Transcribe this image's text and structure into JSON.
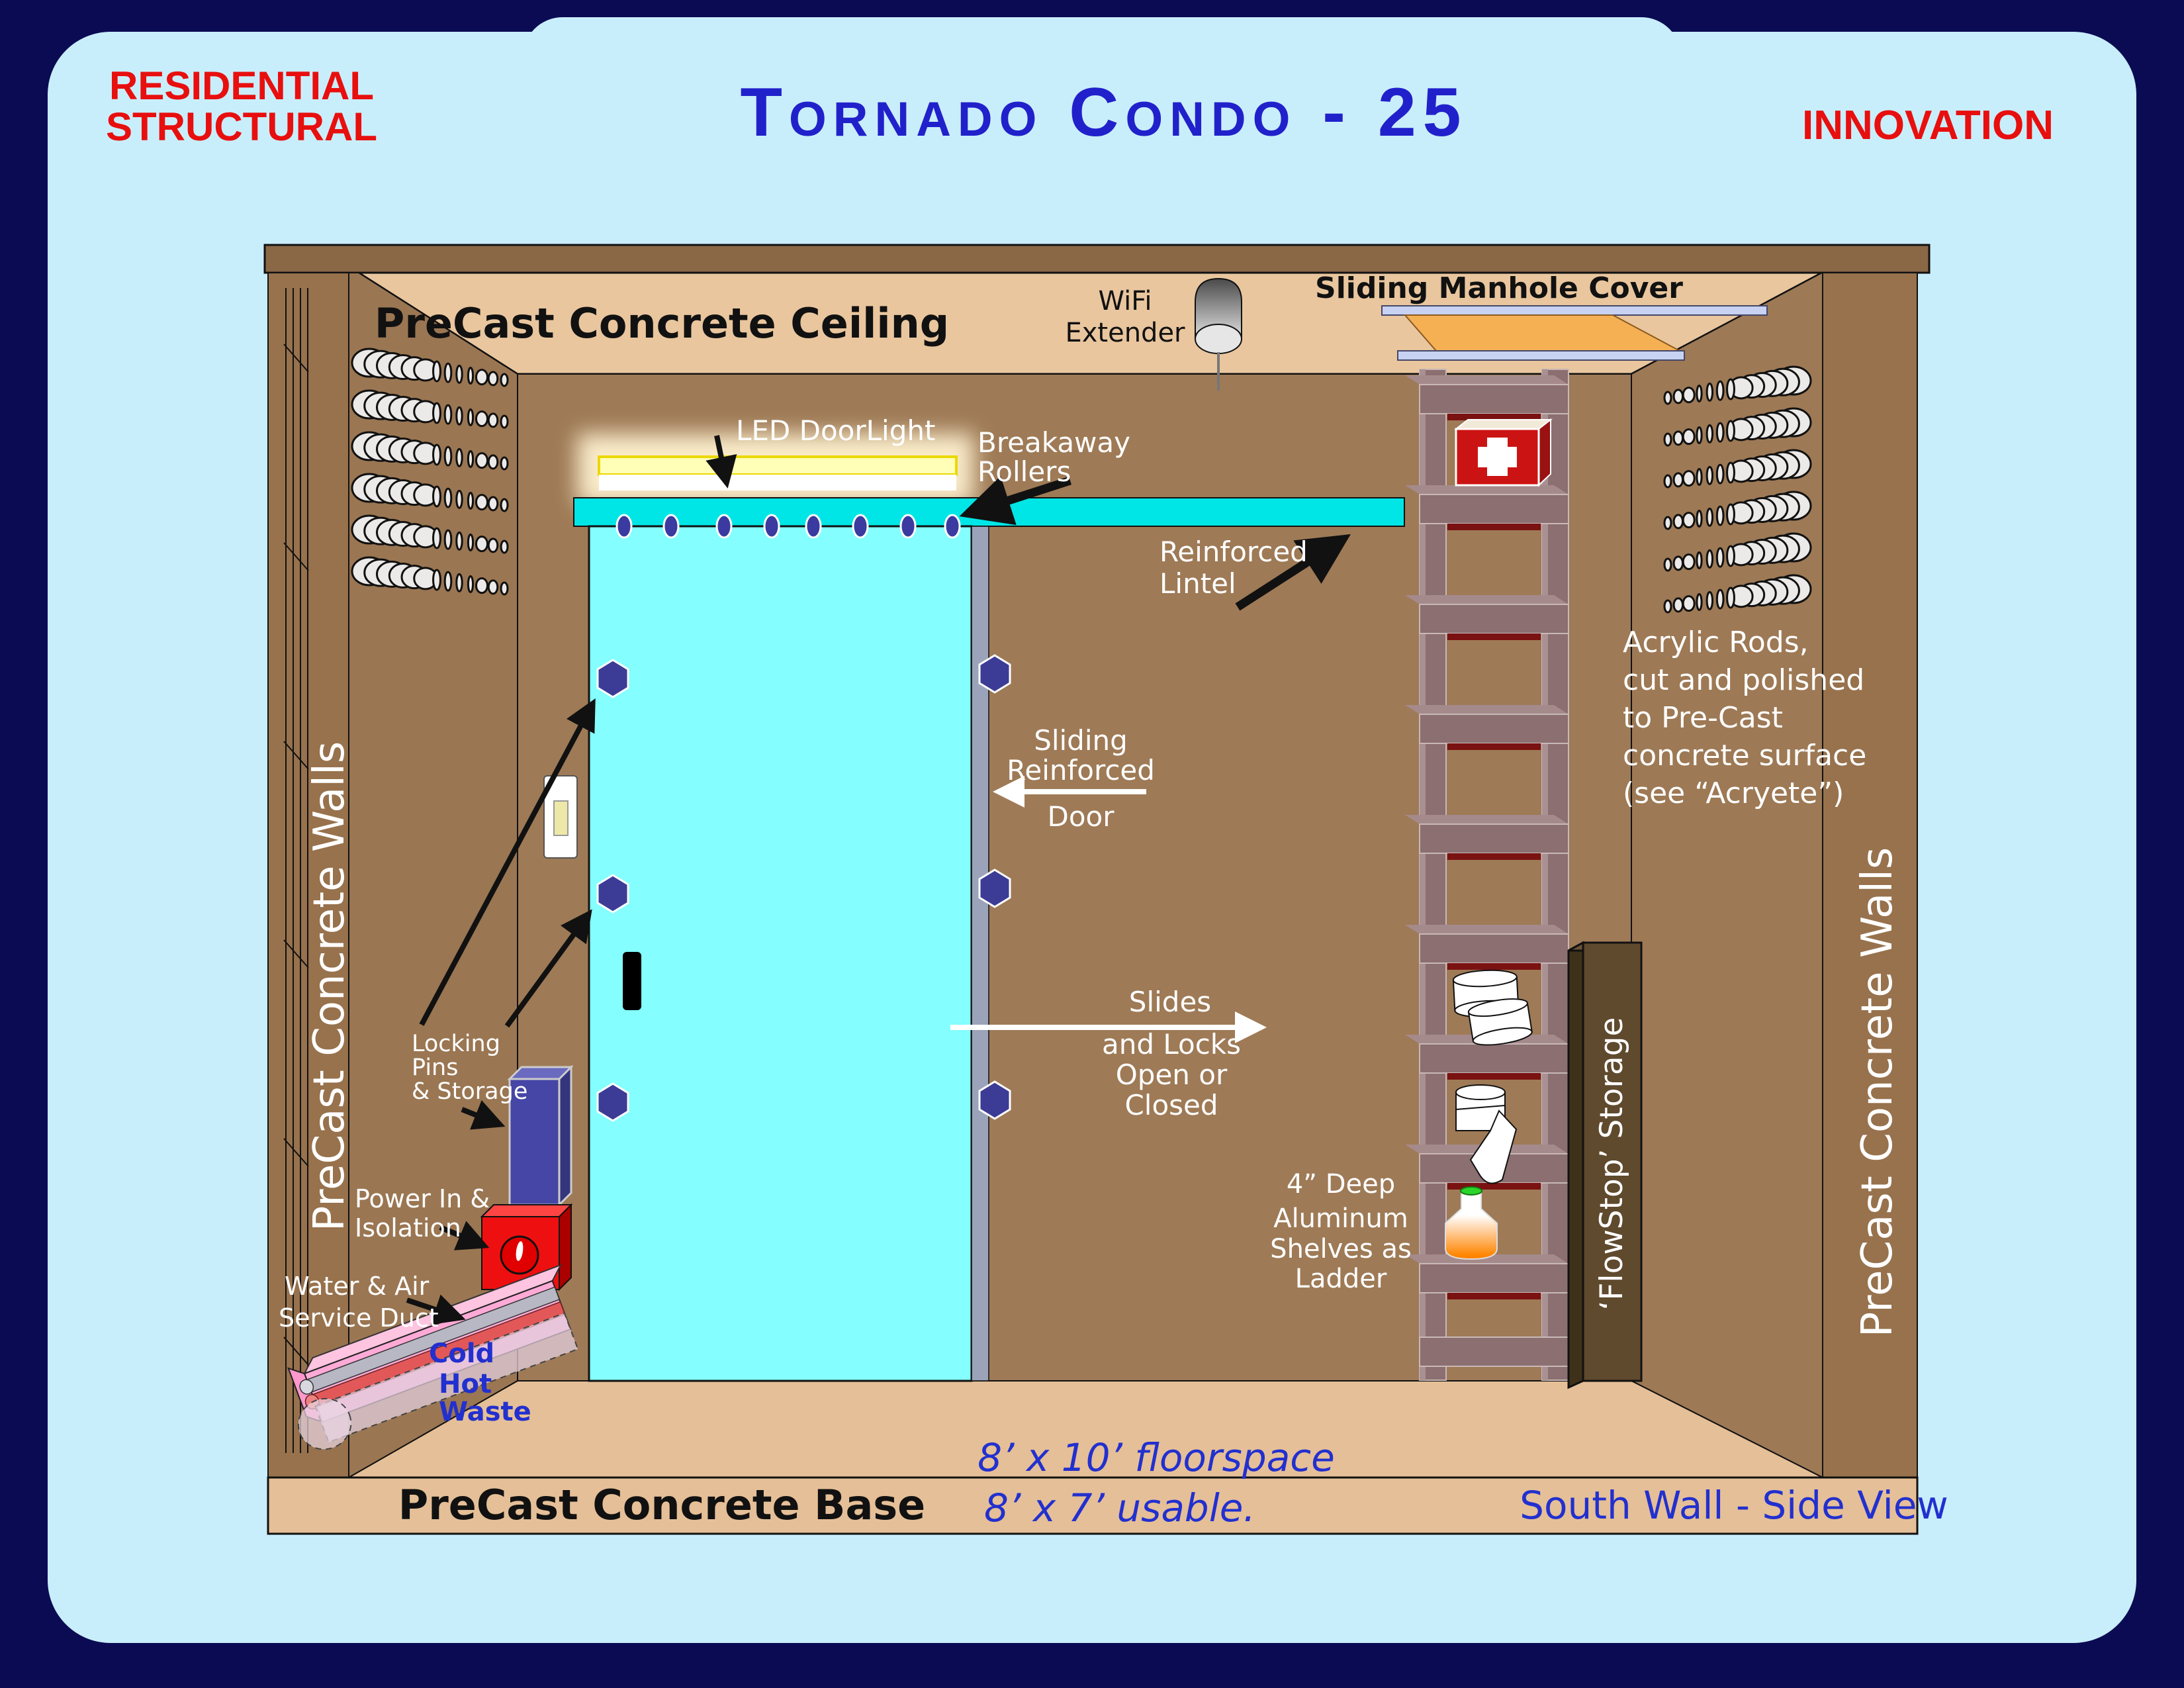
{
  "header": {
    "left_line1": "RESIDENTIAL",
    "left_line2": "STRUCTURAL",
    "title": "Tornado Condo - 25",
    "right": "INNOVATION"
  },
  "colors": {
    "background_navy": "#0b0b54",
    "panel_blue": "#c9eefb",
    "accent_red": "#e80f0f",
    "title_blue": "#2121cb",
    "wall_brown": "#9b7754",
    "ceiling_tan": "#e9c69e",
    "floor_tan": "#e5bf97",
    "door_cyan": "#84fefe",
    "track_cyan": "#00e6e6",
    "pin_navy": "#3c3c96",
    "ladder_mauve": "#8c6f70",
    "duct_pink": "#ffaad6",
    "dim_text_blue": "#2230cf",
    "first_aid_red": "#cc1313",
    "manhole_orange": "#f6b054"
  },
  "diagram": {
    "ceiling_label": "PreCast Concrete Ceiling",
    "base_label": "PreCast Concrete Base",
    "left_wall_label": "PreCast Concrete Walls",
    "right_wall_label": "PreCast Concrete Walls",
    "wifi": [
      "WiFi",
      "Extender"
    ],
    "manhole_label": "Sliding Manhole Cover",
    "led_label": "LED DoorLight",
    "breakaway": [
      "Breakaway",
      "Rollers"
    ],
    "lintel": [
      "Reinforced",
      "Lintel"
    ],
    "sliding_door": [
      "Sliding",
      "Reinforced",
      "Door"
    ],
    "slides": [
      "Slides",
      "and Locks",
      "Open or",
      "Closed"
    ],
    "acrylic": [
      "Acrylic Rods,",
      "cut and polished",
      "to Pre-Cast",
      "concrete surface",
      "(see “Acryete”)"
    ],
    "shelves": [
      "4” Deep",
      "Aluminum",
      "Shelves as",
      "Ladder"
    ],
    "locking": [
      "Locking",
      "Pins",
      "& Storage"
    ],
    "power": [
      "Power In &",
      "Isolation"
    ],
    "water": [
      "Water & Air",
      "Service Duct"
    ],
    "pipes": [
      "Cold",
      "Hot",
      "Waste"
    ],
    "flowstop_label": "‘FlowStop’ Storage",
    "floorspace": "8’ x 10’ floorspace",
    "usable": "8’ x 7’ usable.",
    "view_label": "South Wall - Side View"
  }
}
